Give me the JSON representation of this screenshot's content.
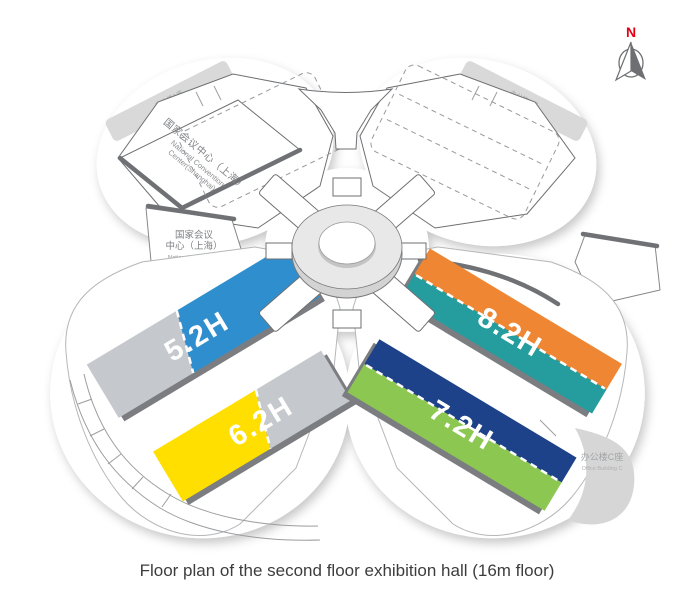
{
  "caption": "Floor plan of the second floor exhibition hall (16m floor)",
  "compass": {
    "north": "N",
    "color": "#e60012"
  },
  "convention_center": {
    "roof_zh": "国家会议中心（上海）",
    "roof_en1": "National Convention",
    "roof_en2": "Center(Shanghai)",
    "side_zh1": "国家会议",
    "side_zh2": "中心（上海）",
    "side_en1": "National Convention",
    "side_en2": "Center(Shanghai)"
  },
  "office_buildings": {
    "a_zh": "办公楼A座",
    "a_en": "Office Building A",
    "b_zh": "办公楼B座",
    "b_en": "Office Building B",
    "c_zh": "办公楼C座",
    "c_en": "Office Building C"
  },
  "halls": [
    {
      "label": "5.2H",
      "colors": {
        "primary": "#2f8fce",
        "secondary": "#c5c8cc"
      }
    },
    {
      "label": "6.2H",
      "colors": {
        "primary": "#ffdf00",
        "secondary": "#c5c8cc"
      }
    },
    {
      "label": "7.2H",
      "colors": {
        "primary": "#1d4289",
        "secondary": "#8bc751"
      }
    },
    {
      "label": "8.2H",
      "colors": {
        "primary": "#ef8633",
        "secondary": "#259d9e"
      }
    }
  ]
}
